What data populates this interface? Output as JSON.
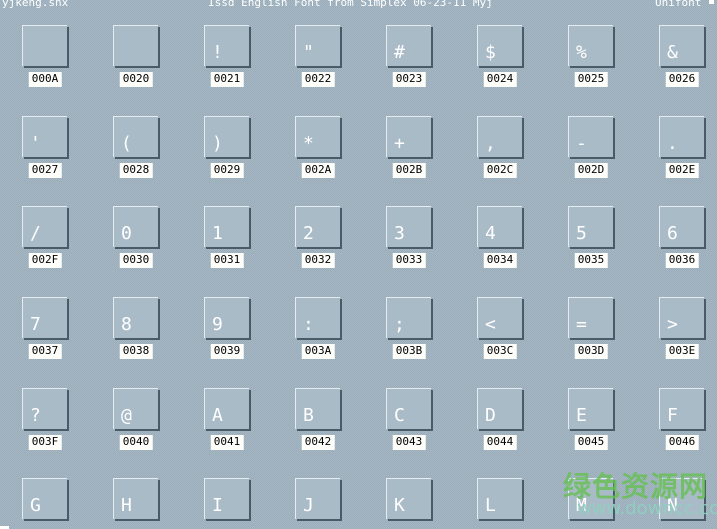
{
  "header": {
    "left": "yjkeng.shx",
    "center": "Issd English Font from Simplex 06-23-11 Myj",
    "right": "Unifont"
  },
  "grid": {
    "columns": 8,
    "rows": 6,
    "cells": [
      {
        "code": "000A",
        "glyph": ""
      },
      {
        "code": "0020",
        "glyph": ""
      },
      {
        "code": "0021",
        "glyph": "!"
      },
      {
        "code": "0022",
        "glyph": "\""
      },
      {
        "code": "0023",
        "glyph": "#"
      },
      {
        "code": "0024",
        "glyph": "$"
      },
      {
        "code": "0025",
        "glyph": "%"
      },
      {
        "code": "0026",
        "glyph": "&"
      },
      {
        "code": "0027",
        "glyph": "'"
      },
      {
        "code": "0028",
        "glyph": "("
      },
      {
        "code": "0029",
        "glyph": ")"
      },
      {
        "code": "002A",
        "glyph": "*"
      },
      {
        "code": "002B",
        "glyph": "+"
      },
      {
        "code": "002C",
        "glyph": ","
      },
      {
        "code": "002D",
        "glyph": "-"
      },
      {
        "code": "002E",
        "glyph": "."
      },
      {
        "code": "002F",
        "glyph": "/"
      },
      {
        "code": "0030",
        "glyph": "0"
      },
      {
        "code": "0031",
        "glyph": "1"
      },
      {
        "code": "0032",
        "glyph": "2"
      },
      {
        "code": "0033",
        "glyph": "3"
      },
      {
        "code": "0034",
        "glyph": "4"
      },
      {
        "code": "0035",
        "glyph": "5"
      },
      {
        "code": "0036",
        "glyph": "6"
      },
      {
        "code": "0037",
        "glyph": "7"
      },
      {
        "code": "0038",
        "glyph": "8"
      },
      {
        "code": "0039",
        "glyph": "9"
      },
      {
        "code": "003A",
        "glyph": ":"
      },
      {
        "code": "003B",
        "glyph": ";"
      },
      {
        "code": "003C",
        "glyph": "<"
      },
      {
        "code": "003D",
        "glyph": "="
      },
      {
        "code": "003E",
        "glyph": ">"
      },
      {
        "code": "003F",
        "glyph": "?"
      },
      {
        "code": "0040",
        "glyph": "@"
      },
      {
        "code": "0041",
        "glyph": "A"
      },
      {
        "code": "0042",
        "glyph": "B"
      },
      {
        "code": "0043",
        "glyph": "C"
      },
      {
        "code": "0044",
        "glyph": "D"
      },
      {
        "code": "0045",
        "glyph": "E"
      },
      {
        "code": "0046",
        "glyph": "F"
      },
      {
        "code": "",
        "glyph": "G"
      },
      {
        "code": "",
        "glyph": "H"
      },
      {
        "code": "",
        "glyph": "I"
      },
      {
        "code": "",
        "glyph": "J"
      },
      {
        "code": "",
        "glyph": "K"
      },
      {
        "code": "",
        "glyph": "L"
      },
      {
        "code": "",
        "glyph": "M"
      },
      {
        "code": "",
        "glyph": "N"
      }
    ]
  },
  "watermark": {
    "title": "绿色资源网",
    "url": "www.downcc.com"
  },
  "colors": {
    "background": "#9fb2bf",
    "box_fill": "#aabbc8",
    "box_highlight": "#e4ecf1",
    "box_shadow": "#4a5a66",
    "glyph_color": "#ffffff",
    "label_background": "#fdfdf9",
    "label_text": "#000000",
    "header_text": "#ffffff",
    "watermark_green": "#68be58",
    "watermark_teal": "#8ed0c0"
  }
}
